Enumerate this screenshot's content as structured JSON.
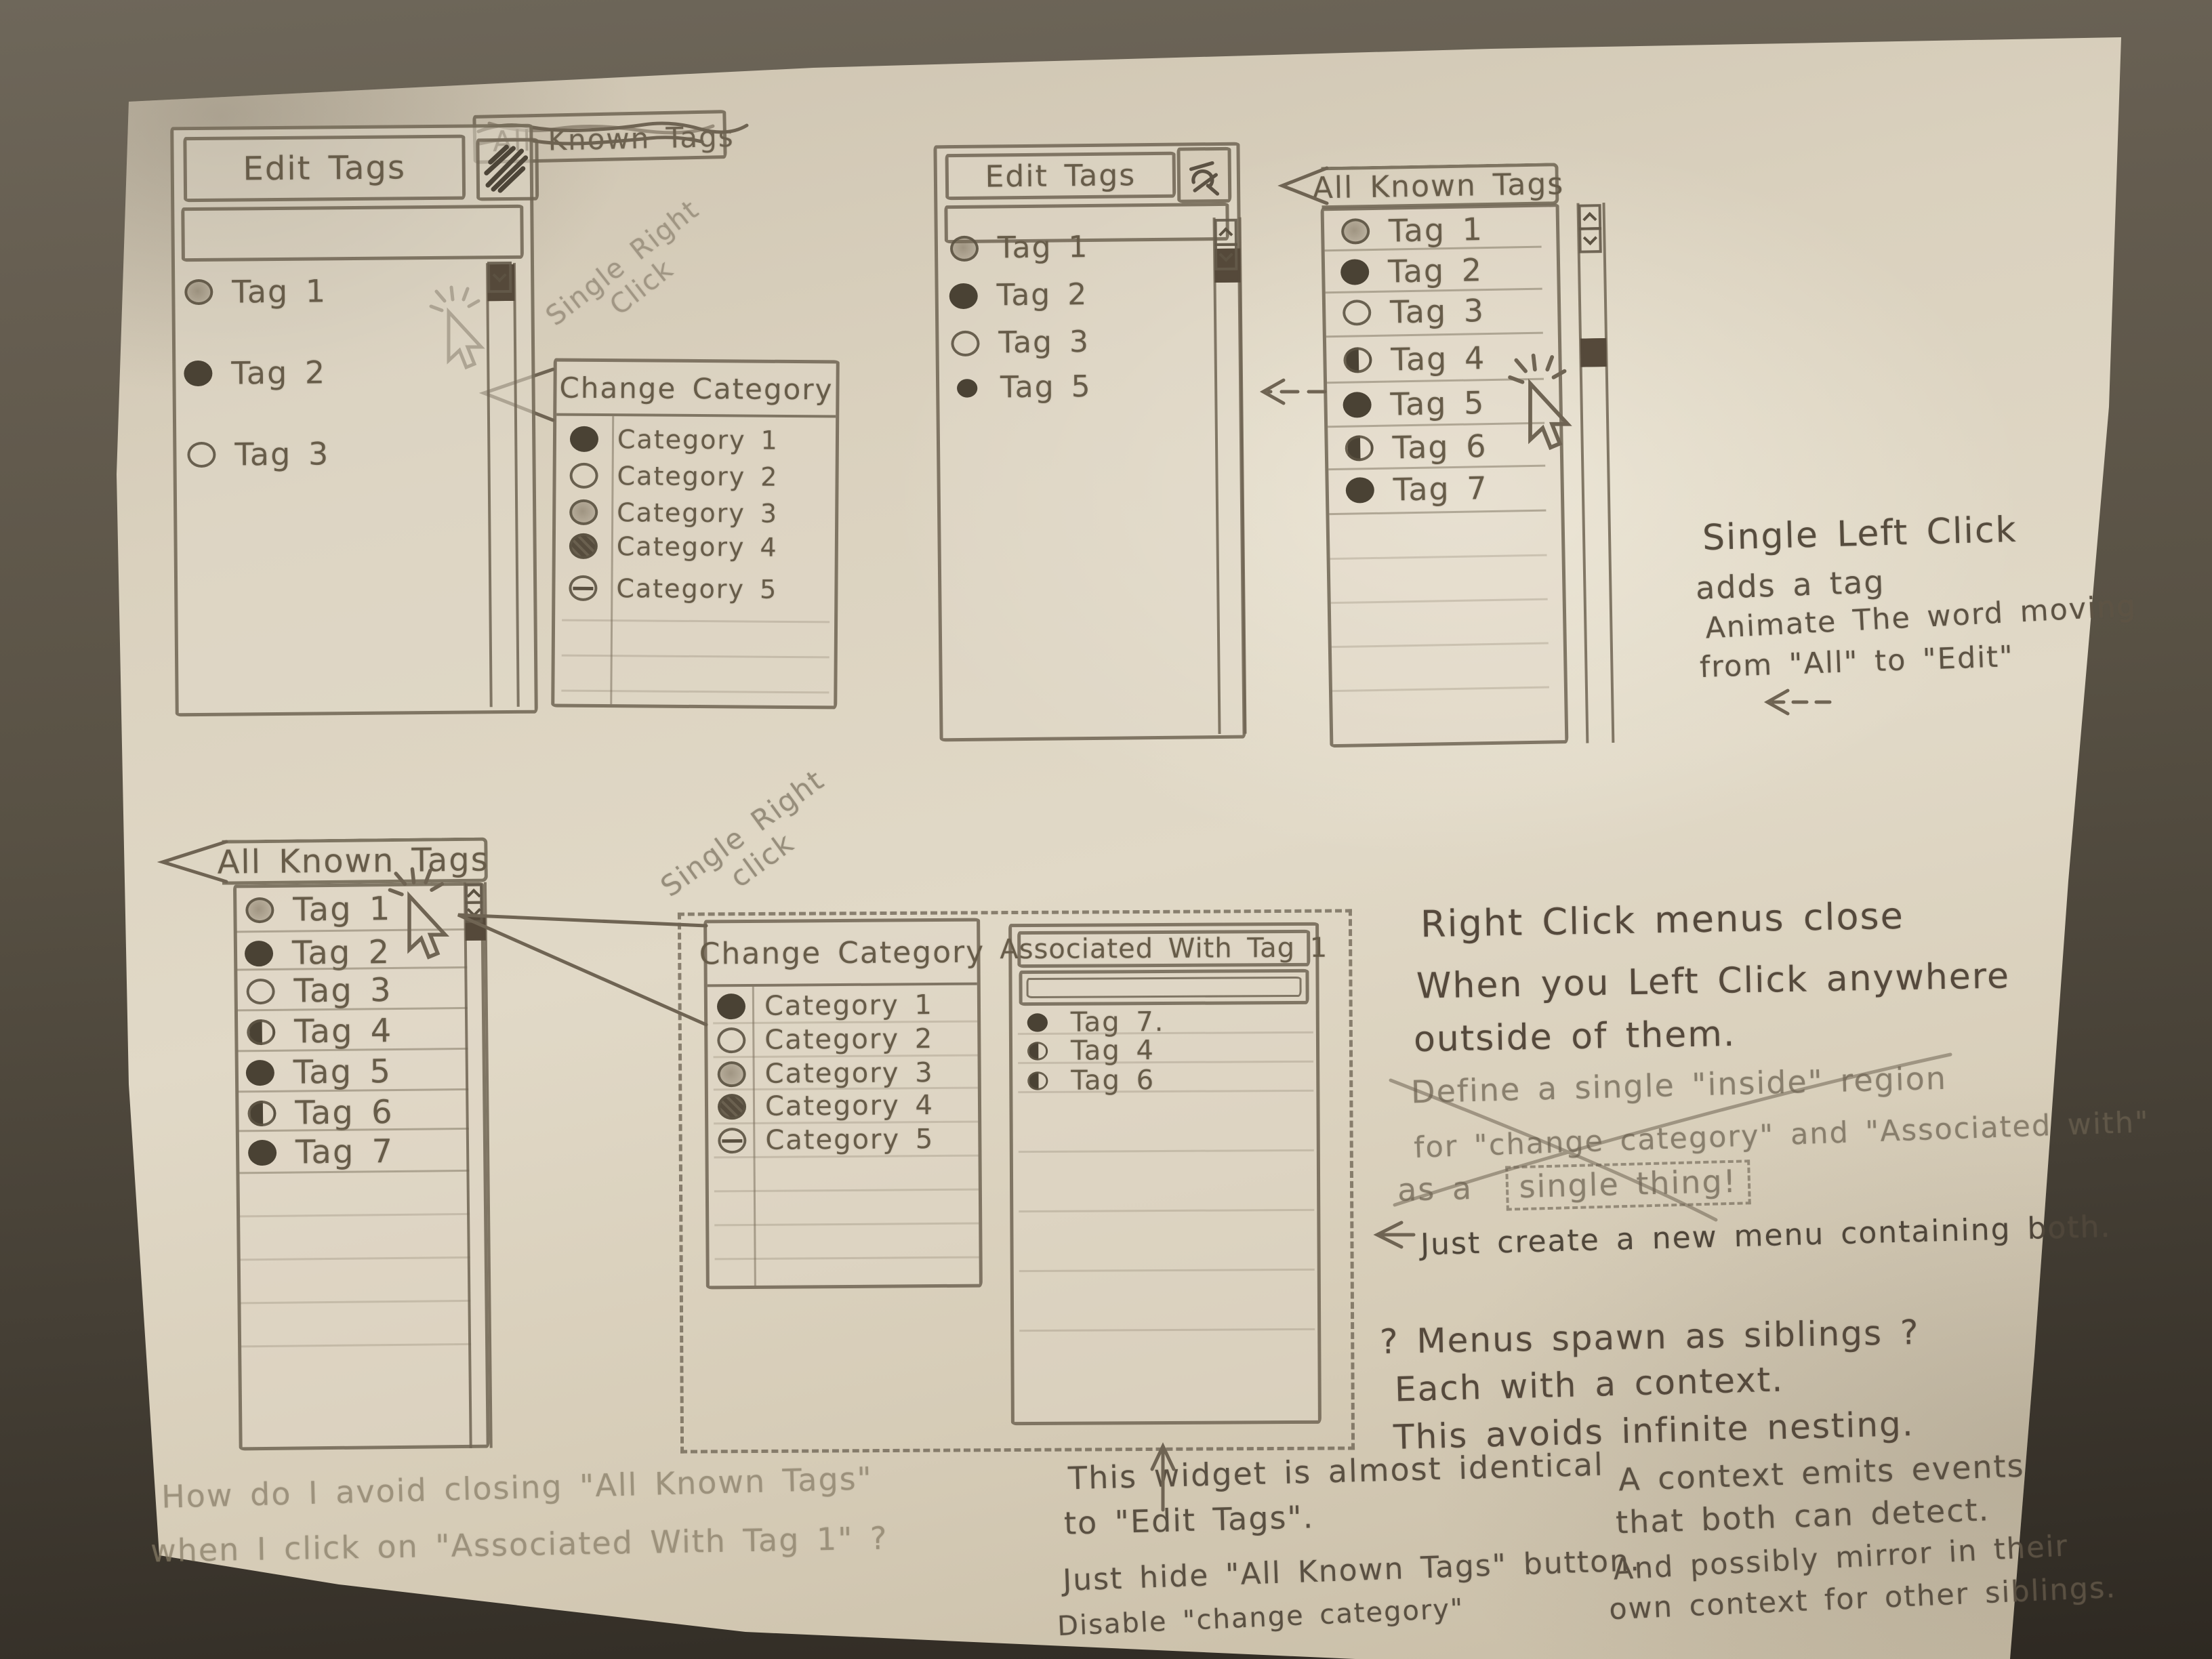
{
  "colors": {
    "paper": "#ddd4c0",
    "ink": "#6f6453",
    "text": "#675c49",
    "table": "#453f35"
  },
  "crossed_tab": {
    "label": "All Known Tags"
  },
  "edit_tags_1": {
    "title": "Edit Tags",
    "search_value": "",
    "items": [
      {
        "label": "Tag 1",
        "icon": "radio-shaded"
      },
      {
        "label": "Tag 2",
        "icon": "radio-filled"
      },
      {
        "label": "Tag 3",
        "icon": "radio-open"
      }
    ]
  },
  "change_category_1": {
    "title": "Change Category",
    "items": [
      {
        "label": "Category 1",
        "icon": "radio-filled"
      },
      {
        "label": "Category 2",
        "icon": "radio-open"
      },
      {
        "label": "Category 3",
        "icon": "radio-shaded"
      },
      {
        "label": "Category 4",
        "icon": "radio-dark"
      },
      {
        "label": "Category 5",
        "icon": "radio-slash"
      }
    ]
  },
  "edit_tags_2": {
    "title": "Edit Tags",
    "search_value": "",
    "items": [
      {
        "label": "Tag 1",
        "icon": "radio-shaded"
      },
      {
        "label": "Tag 2",
        "icon": "radio-filled"
      },
      {
        "label": "Tag 3",
        "icon": "radio-open"
      },
      {
        "label": "Tag 5",
        "icon": "radio-dot"
      }
    ]
  },
  "all_known_tags_top": {
    "title": "All Known Tags",
    "items": [
      {
        "label": "Tag 1",
        "icon": "radio-shaded"
      },
      {
        "label": "Tag 2",
        "icon": "radio-filled"
      },
      {
        "label": "Tag 3",
        "icon": "radio-open"
      },
      {
        "label": "Tag 4",
        "icon": "radio-half"
      },
      {
        "label": "Tag 5",
        "icon": "radio-filled"
      },
      {
        "label": "Tag 6",
        "icon": "radio-half"
      },
      {
        "label": "Tag 7",
        "icon": "radio-filled"
      }
    ]
  },
  "all_known_tags_bottom": {
    "title": "All Known Tags",
    "items": [
      {
        "label": "Tag 1",
        "icon": "radio-shaded"
      },
      {
        "label": "Tag 2",
        "icon": "radio-filled"
      },
      {
        "label": "Tag 3",
        "icon": "radio-open"
      },
      {
        "label": "Tag 4",
        "icon": "radio-half"
      },
      {
        "label": "Tag 5",
        "icon": "radio-filled"
      },
      {
        "label": "Tag 6",
        "icon": "radio-half"
      },
      {
        "label": "Tag 7",
        "icon": "radio-filled"
      }
    ]
  },
  "change_category_2": {
    "title": "Change Category",
    "items": [
      {
        "label": "Category 1",
        "icon": "radio-filled"
      },
      {
        "label": "Category 2",
        "icon": "radio-open"
      },
      {
        "label": "Category 3",
        "icon": "radio-shaded"
      },
      {
        "label": "Category 4",
        "icon": "radio-dark"
      },
      {
        "label": "Category 5",
        "icon": "radio-slash"
      }
    ]
  },
  "associated_with_tag1": {
    "title": "Associated With Tag 1",
    "search_value": "",
    "items": [
      {
        "label": "Tag 7.",
        "icon": "radio-filled"
      },
      {
        "label": "Tag 4",
        "icon": "radio-half"
      },
      {
        "label": "Tag 6",
        "icon": "radio-half"
      }
    ]
  },
  "annotations": {
    "single_right_click_1": {
      "line1": "Single Right",
      "line2": "Click"
    },
    "single_right_click_2": {
      "line1": "Single Right",
      "line2": "click"
    },
    "single_left_click": {
      "line1": "Single Left Click",
      "line2": "adds a tag",
      "line3": "Animate The word moving",
      "line4": "from \"All\" to \"Edit\""
    },
    "right_click_note": {
      "line1": "Right Click menus close",
      "line2": "When you Left Click anywhere",
      "line3": "outside of them."
    },
    "struck_note": {
      "line1": "Define a single \"inside\" region",
      "line2": "for \"change category\" and \"Associated with\"",
      "line3_prefix": "as a",
      "line3_boxed": "single thing!"
    },
    "just_create": "Just create a new menu containing both.",
    "siblings_note": {
      "line1": "? Menus spawn as siblings ?",
      "line2": "Each with a context.",
      "line3": "This avoids infinite nesting."
    },
    "widget_note": {
      "line1": "This widget is almost identical",
      "line2": "to \"Edit Tags\".",
      "line3": "Just hide \"All Known Tags\" button.",
      "line4": "Disable \"change category\""
    },
    "context_note": {
      "line1": "A context emits events",
      "line2": "that both can detect.",
      "line3": "And possibly mirror in their",
      "line4": "own context for other siblings."
    },
    "question_note": {
      "line1": "How do I avoid closing \"All Known Tags\"",
      "line2": "when I click on \"Associated With Tag 1\" ?"
    }
  }
}
